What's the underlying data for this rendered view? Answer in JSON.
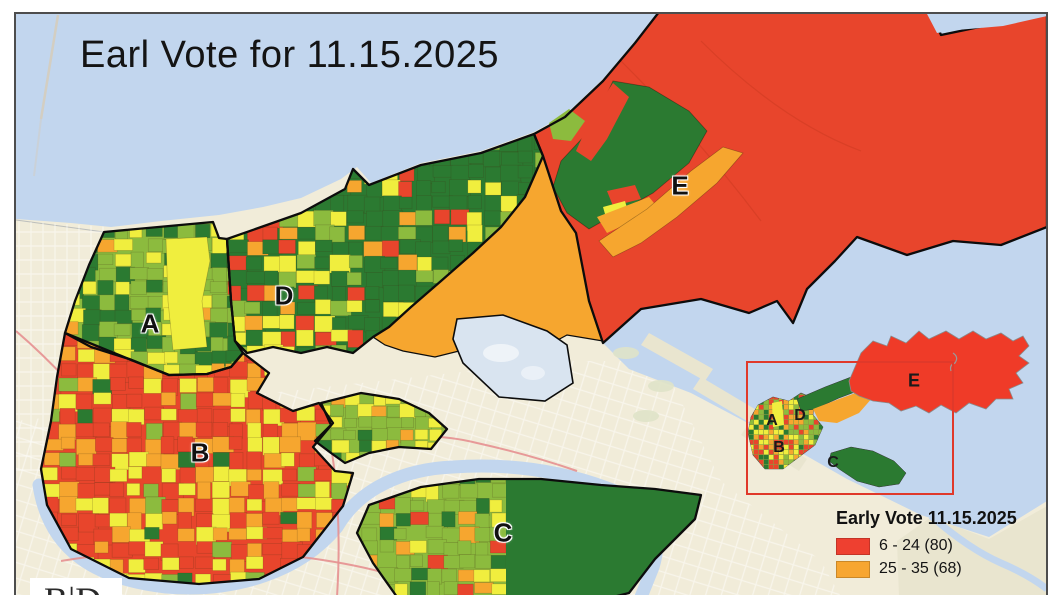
{
  "title": "Earl Vote for 11.15.2025",
  "legend": {
    "title": "Early Vote 11.15.2025",
    "entries": [
      {
        "label": "6 - 24 (80)",
        "color": "#ee4030"
      },
      {
        "label": "25 - 35 (68)",
        "color": "#f7a631"
      }
    ]
  },
  "map": {
    "district_labels": [
      "A",
      "B",
      "C",
      "D",
      "E"
    ]
  },
  "inset": {
    "district_labels": [
      "A",
      "B",
      "C",
      "D",
      "E"
    ]
  },
  "logo": {
    "text": "B|D"
  },
  "palette": {
    "red": "#e8452c",
    "orange": "#f6a62f",
    "yellow": "#f0ee3e",
    "light_green": "#8cbb3e",
    "dark_green": "#2b7a31",
    "water": "#c2d6ee",
    "land": "#f1ecd9",
    "marsh": "#e9e5cf",
    "boundary": "#0c0c0c",
    "inset_red": "#ef3b28",
    "extent_rect": "#e0392a",
    "highway": "#e59090"
  }
}
